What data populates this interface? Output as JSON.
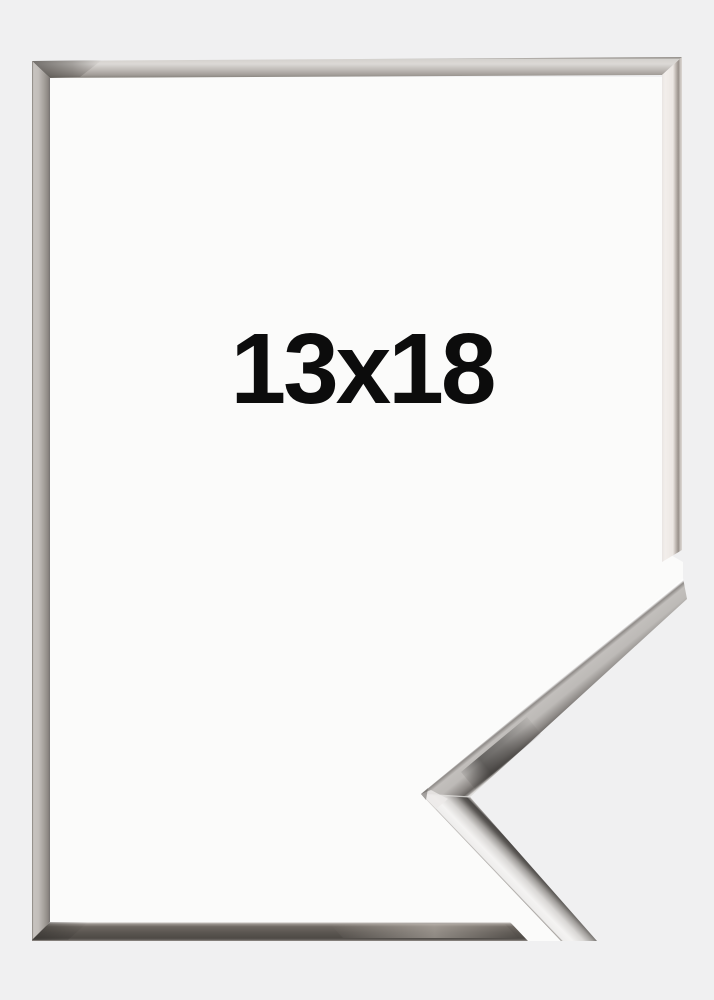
{
  "product": {
    "size_label": "13x18",
    "colors": {
      "background": "#f0f0f1",
      "frame_interior": "#fbfbfa",
      "label_text": "#0c0c0c",
      "chrome_highlight": "#f4f3f2",
      "chrome_mid": "#bdbab7",
      "chrome_dark": "#5b5651"
    }
  }
}
